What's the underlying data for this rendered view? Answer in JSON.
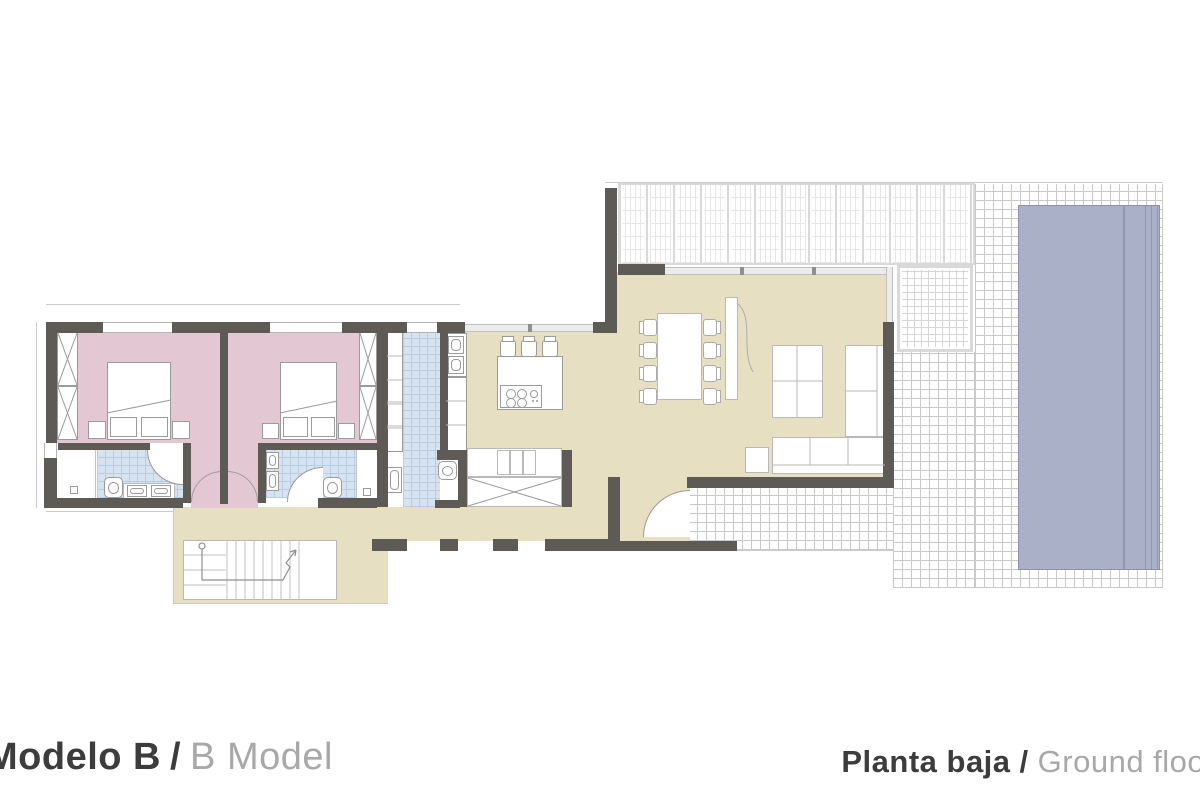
{
  "footer": {
    "left": {
      "label_primary": "Modelo B",
      "separator": "/",
      "label_secondary": "B Model"
    },
    "right": {
      "label_primary": "Planta baja",
      "separator": "/",
      "label_secondary": "Ground floor"
    }
  },
  "colors": {
    "wall": "#5e5b57",
    "floor_interior": "#e6dfc1",
    "floor_bedroom": "#e3c8d4",
    "floor_bath_tile": "#d8e3f0",
    "bath_tile_line": "#b8cde2",
    "pool_water": "#abb0c9",
    "pool_line": "#8b91ae",
    "terrace_grid_line": "#c9c9c9",
    "pergola_frame": "#d9d9d9",
    "fixture_outline": "#9b9b9b",
    "outline_thin": "#cbcbcb",
    "text_primary": "#3c3c3c",
    "text_secondary": "#a8a8a8",
    "background": "#ffffff"
  },
  "plan": {
    "type": "residential-floor-plan",
    "rooms": [
      "bedroom-1",
      "bedroom-2",
      "bathroom-1",
      "bathroom-2",
      "wc-laundry",
      "kitchen-dining",
      "living-room",
      "entry-hall",
      "hallway",
      "stairs",
      "pergola-terrace",
      "tiled-terrace",
      "pool"
    ],
    "fixtures": [
      "double-bed",
      "wardrobe",
      "nightstand",
      "toilet",
      "double-sink",
      "kitchen-island",
      "cooktop",
      "bar-stool",
      "dining-table",
      "chair",
      "sofa",
      "rug",
      "tv-cabinet",
      "side-table",
      "stairs-arrow"
    ]
  }
}
